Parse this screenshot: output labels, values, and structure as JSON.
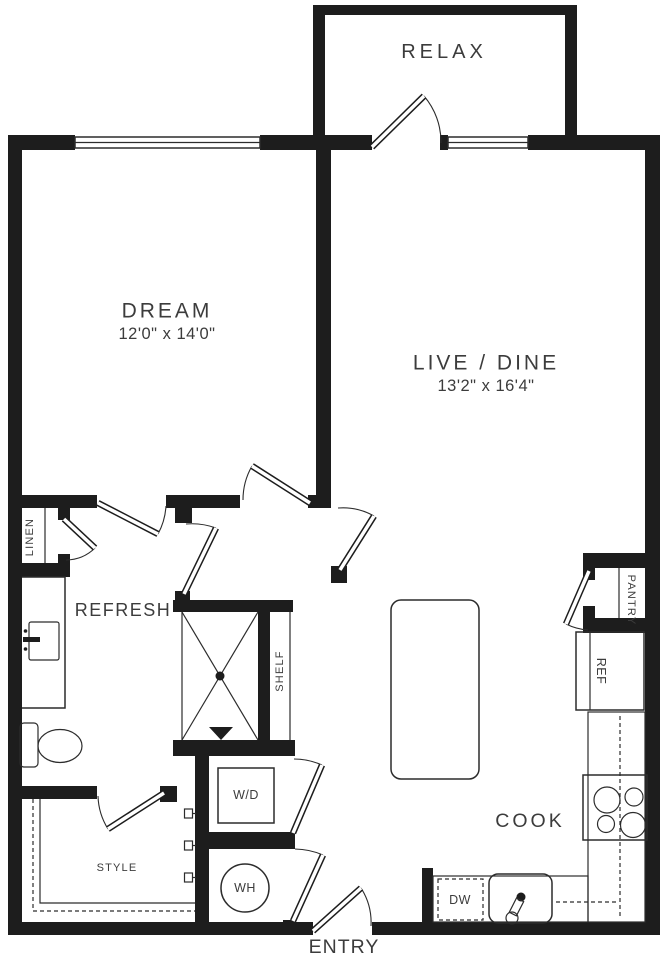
{
  "plan": {
    "colors": {
      "background": "#ffffff",
      "wall": "#1d1d1d",
      "line": "#2c2c2c",
      "text": "#3c3c3c"
    },
    "rooms": {
      "relax": {
        "label": "RELAX"
      },
      "dream": {
        "label": "DREAM",
        "dims": "12'0\" x 14'0\""
      },
      "live_dine": {
        "label": "LIVE / DINE",
        "dims": "13'2\" x 16'4\""
      },
      "refresh": {
        "label": "REFRESH"
      },
      "cook": {
        "label": "COOK"
      },
      "entry": {
        "label": "ENTRY"
      },
      "style": {
        "label": "STYLE"
      }
    },
    "closets": {
      "linen": {
        "label": "LINEN"
      },
      "pantry": {
        "label": "PANTRY"
      },
      "shelf": {
        "label": "SHELF"
      }
    },
    "appliances": {
      "washer_dryer": {
        "label": "W/D"
      },
      "water_heater": {
        "label": "WH"
      },
      "dishwasher": {
        "label": "DW"
      },
      "refrigerator": {
        "label": "REF"
      }
    }
  }
}
